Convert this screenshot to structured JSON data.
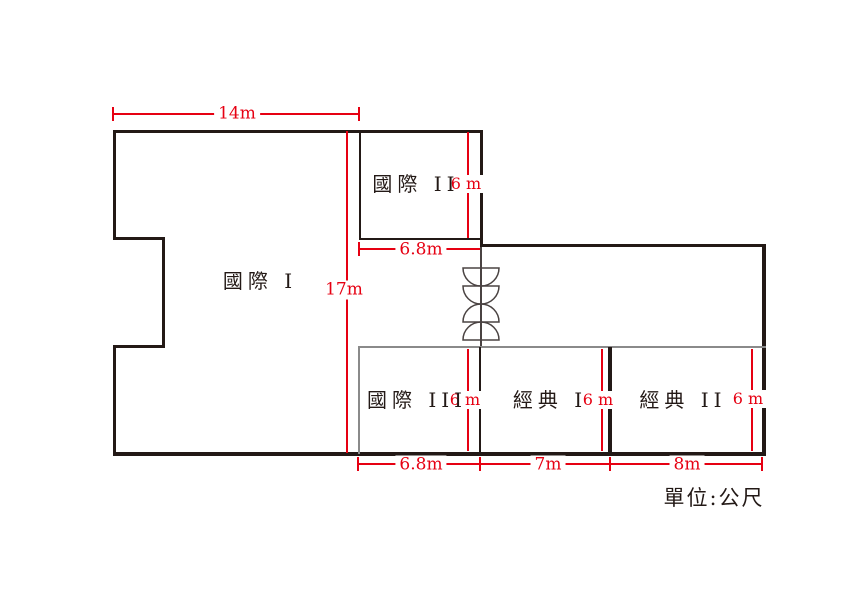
{
  "unit_label": "單位:公尺",
  "colors": {
    "dimension_red": "#e60012",
    "wall_dark": "#231916",
    "wall_gray": "#8a8a8a"
  },
  "rooms": {
    "intl1": {
      "name": "國際 I"
    },
    "intl2": {
      "name": "國際 II",
      "width": "6.8m",
      "depth": "6 m"
    },
    "intl3": {
      "name": "國際 III",
      "width": "6.8m",
      "depth": "6 m"
    },
    "classic1": {
      "name": "經典 I",
      "width": "7m",
      "depth": "6 m"
    },
    "classic2": {
      "name": "經典 II",
      "width": "8m",
      "depth": "6 m"
    }
  },
  "overall": {
    "top_width": "14m",
    "total_depth": "17m"
  },
  "icons": {
    "door": "double-swing-doors-icon"
  }
}
